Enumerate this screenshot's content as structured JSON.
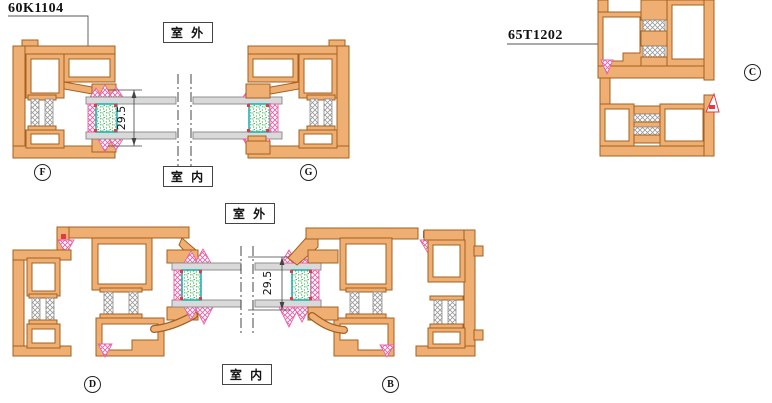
{
  "drawing": {
    "title_codes": {
      "top_left": "60K1104",
      "right": "65T1202"
    },
    "environment_labels": {
      "outdoor": "室 外",
      "indoor": "室 内"
    },
    "dimensions": {
      "top_glass_thickness": "29.5",
      "bottom_glass_thickness": "29.5"
    },
    "section_letters": {
      "f": "F",
      "g": "G",
      "c": "C",
      "d": "D",
      "b": "B"
    }
  },
  "colors": {
    "profile_fill": "#EFAF72",
    "profile_stroke": "#A3601F",
    "glass_fill": "#D9D9D9",
    "seal_pink": "#E85FA8",
    "accent_red": "#E63946",
    "spacer_green": "#1FA93C",
    "spacer_teal": "#1FB3B3",
    "hatch_gray": "#9A9A9A"
  }
}
